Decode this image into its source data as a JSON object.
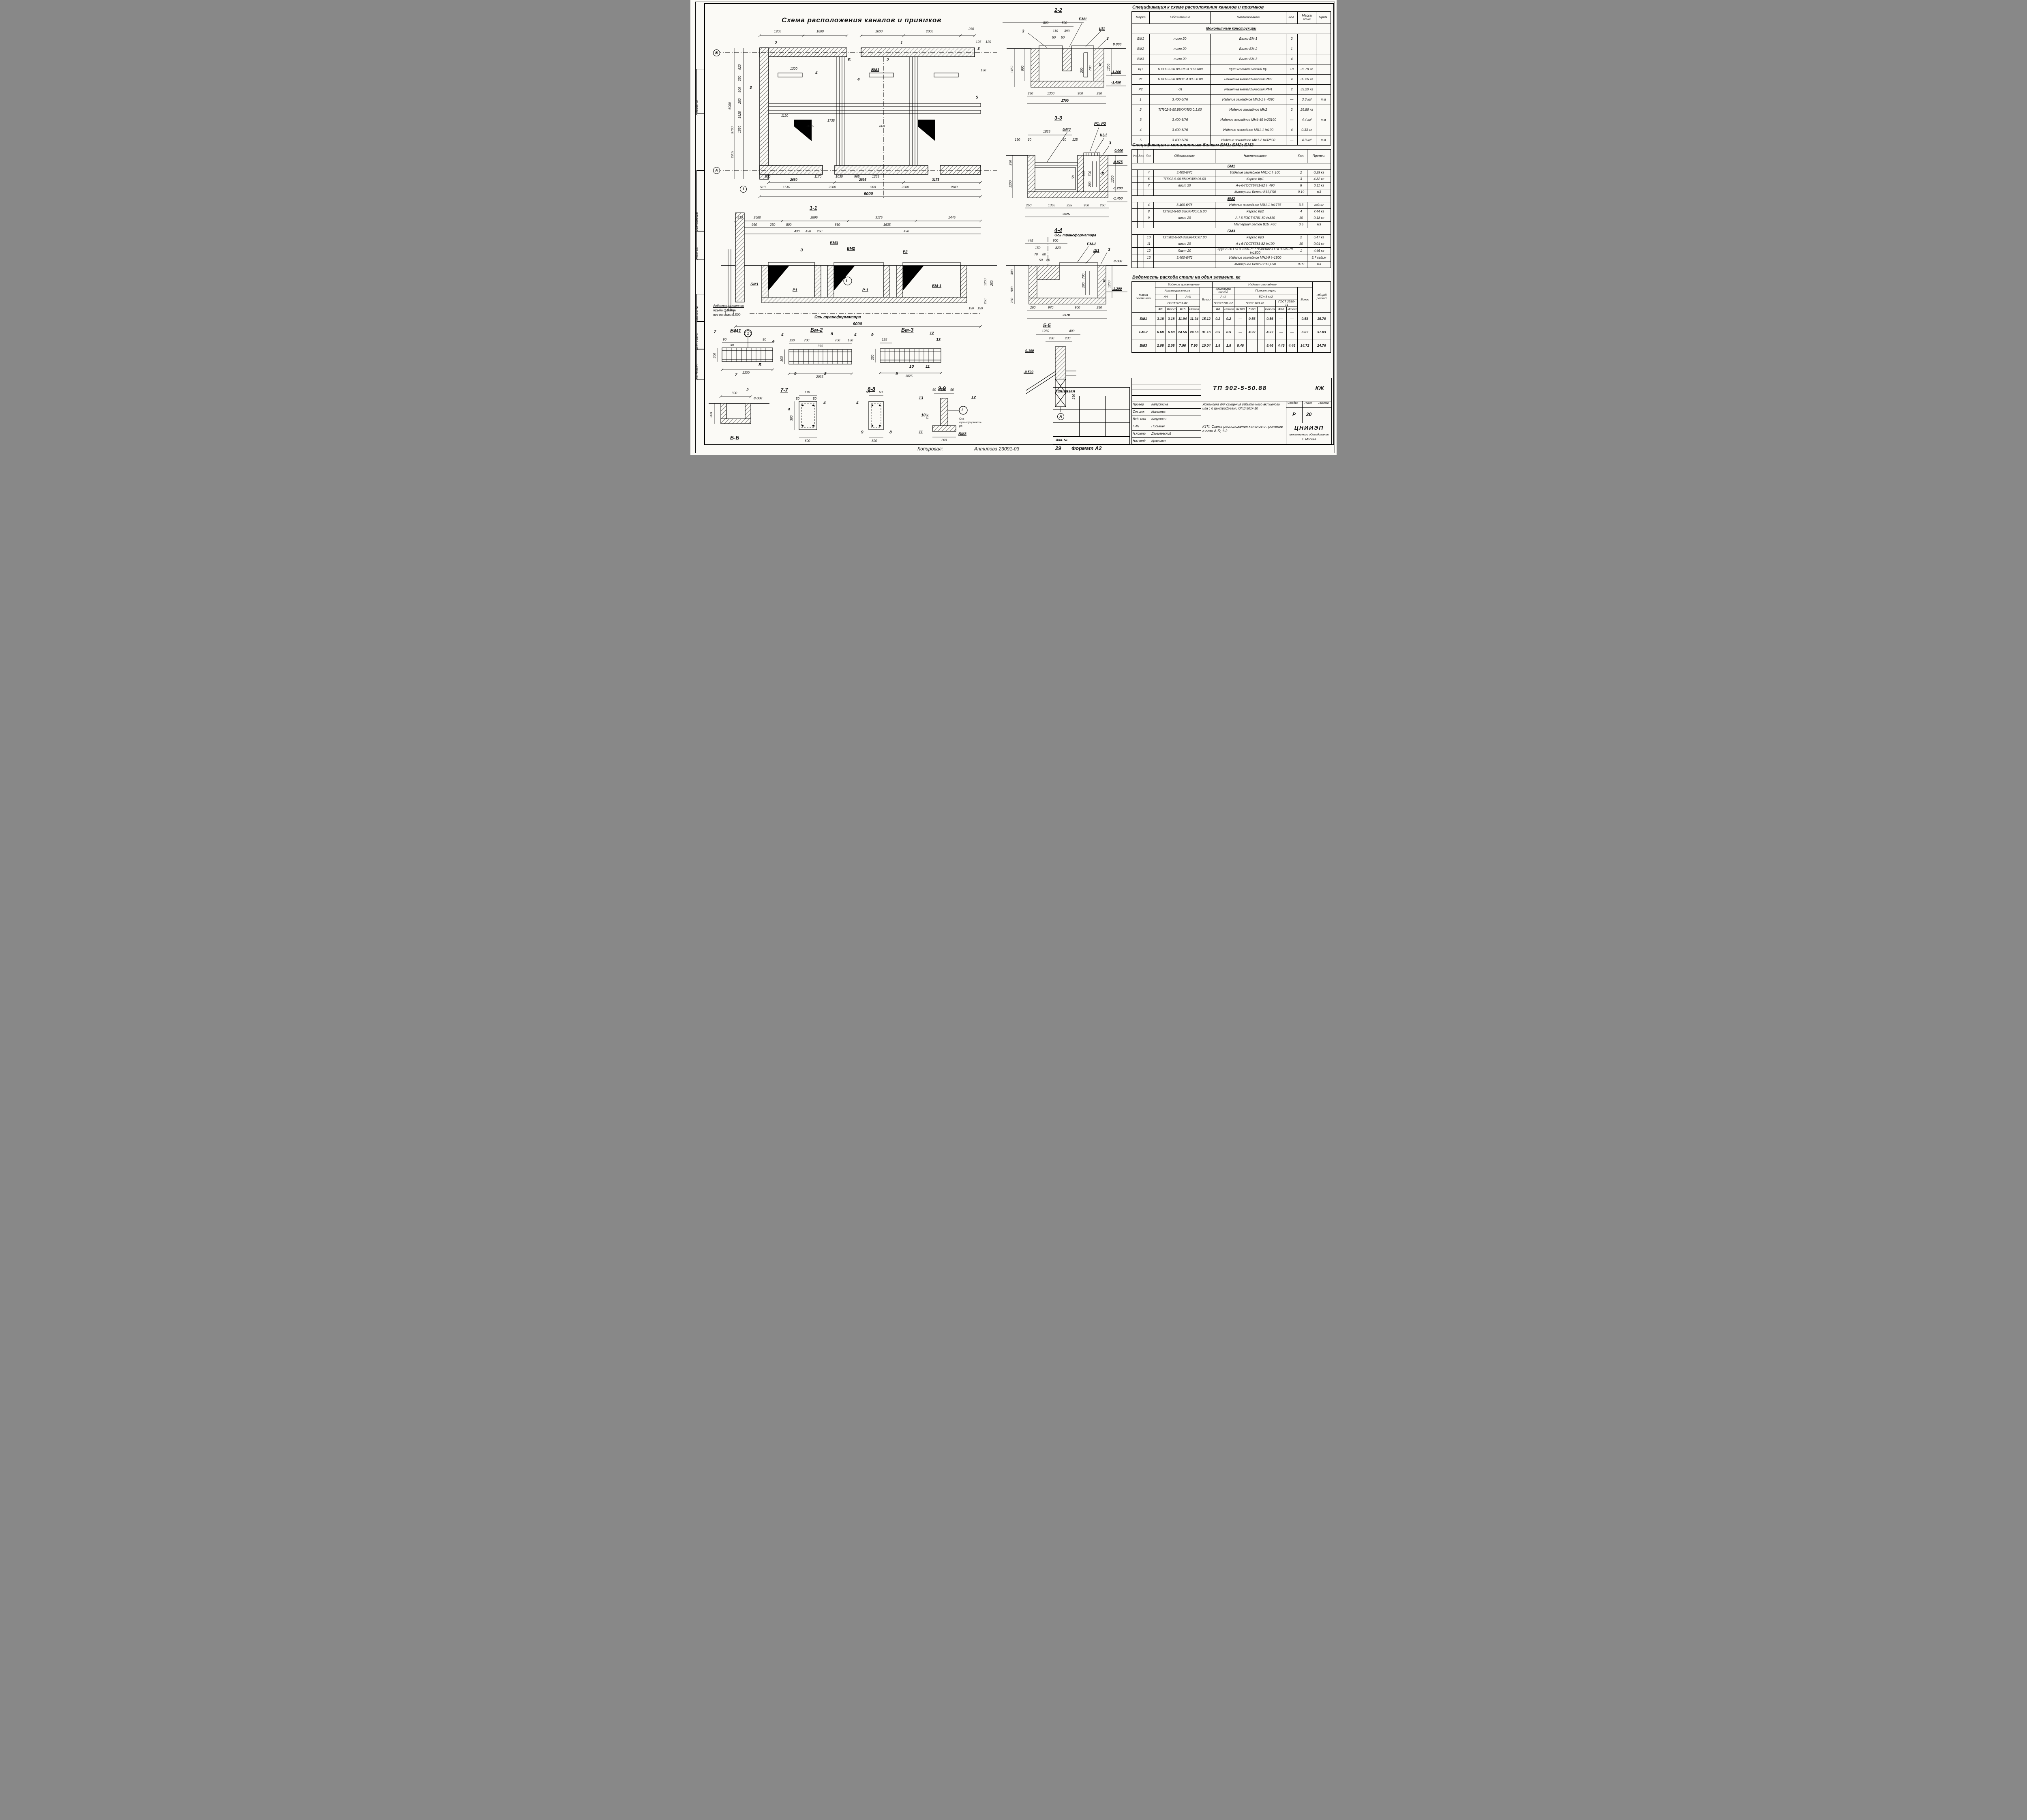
{
  "page": {
    "copied": "Копировал:",
    "copied_by": "Антипова 23091-03",
    "copied_num": "29",
    "format": "Формат А2"
  },
  "sidebar": {
    "album": "Альбом III",
    "agreed": "Согласовано",
    "dept": "Отдел з.д.",
    "vzam": "Взам. инв. №",
    "podp": "Подп. и дата",
    "inv": "Инв. № подл."
  },
  "plan": {
    "title": "Схема расположения каналов и приямков",
    "dims": [
      "1200",
      "1600",
      "1600",
      "2000",
      "250",
      "6000",
      "820",
      "250",
      "900",
      "250",
      "1825",
      "1550",
      "3780",
      "2205",
      "1170",
      "1030",
      "965",
      "1235",
      "500",
      "510",
      "1510",
      "2200",
      "900",
      "2200",
      "1940",
      "9000",
      "2680",
      "2895",
      "3175",
      "150",
      "125",
      "125",
      "2035",
      "860",
      "1300"
    ],
    "marks": [
      "2",
      "Б",
      "1",
      "3",
      "4",
      "БМ1",
      "5",
      "2",
      "3",
      "4",
      "1735",
      "1120"
    ],
    "axis": [
      "Б",
      "А",
      "1"
    ]
  },
  "s11": {
    "title": "1-1",
    "dims": [
      "510",
      "2680",
      "2895",
      "3175",
      "1445",
      "950",
      "250",
      "800",
      "860",
      "1635",
      "430",
      "430",
      "250",
      "490",
      "9000",
      "150",
      "150",
      "1200",
      "250",
      "250"
    ],
    "marks": [
      "3",
      "БМ3",
      "БМ2",
      "Р2",
      "БМ1",
      "Р1",
      "Р-1",
      "БМ-1",
      "З",
      "I"
    ],
    "note": [
      "Асбестоцементная",
      "труба ф100мм",
      "низ на отм.-0.500"
    ],
    "axis_label": "Ось трансформатора"
  },
  "s22": {
    "title": "2-2",
    "dims": [
      "800",
      "500",
      "110",
      "390",
      "50",
      "50",
      "1450",
      "900",
      "200",
      "700",
      "1200",
      "250",
      "1300",
      "900",
      "250",
      "2700"
    ],
    "elev": [
      "0.000",
      "-1.200",
      "-1.450"
    ],
    "marks": [
      "3",
      "БМ1",
      "Щ1",
      "3",
      "5"
    ]
  },
  "s33": {
    "title": "3-3",
    "dims": [
      "1825",
      "190",
      "60",
      "60",
      "125",
      "250",
      "1200",
      "125",
      "700",
      "200",
      "1200",
      "250",
      "1350",
      "225",
      "900",
      "250",
      "3025"
    ],
    "elev": [
      "0.000",
      "-0.875",
      "-1.200",
      "-1.450"
    ],
    "marks": [
      "БМ3",
      "Р1; Р2",
      "Щ-1",
      "3",
      "5",
      "5"
    ]
  },
  "s44": {
    "title": "4-4",
    "axis_label": "Ось трансформатора",
    "dims": [
      "445",
      "900",
      "150",
      "820",
      "70",
      "80",
      "50",
      "60",
      "300",
      "900",
      "250",
      "1200",
      "200",
      "700",
      "260",
      "970",
      "900",
      "250",
      "2370"
    ],
    "elev": [
      "0.000",
      "-1.200"
    ],
    "marks": [
      "БМ-2",
      "Щ1",
      "3",
      "5"
    ]
  },
  "s55": {
    "title": "5-5",
    "dims": [
      "1250",
      "400",
      "280",
      "230",
      "250"
    ],
    "elev": [
      "0.100",
      "-0.500"
    ],
    "axis": "А"
  },
  "bm1": {
    "title": "БМ1",
    "dims": [
      "90",
      "30",
      "90",
      "300",
      "1300"
    ],
    "marks": [
      "7",
      "7",
      "4",
      "Б"
    ],
    "axis": "1"
  },
  "bb": {
    "title": "Б-Б",
    "dims": [
      "300",
      "200"
    ],
    "elev": "0.000",
    "marks": [
      "2"
    ]
  },
  "bm2": {
    "title": "Бм-2",
    "dims": [
      "130",
      "700",
      "375",
      "700",
      "130",
      "300",
      "2035"
    ],
    "marks": [
      "8",
      "8",
      "9",
      "4",
      "4"
    ]
  },
  "s77": {
    "title": "7-7",
    "dims": [
      "110",
      "50",
      "50",
      "300",
      "600"
    ],
    "marks": [
      "4",
      "4"
    ]
  },
  "bm3": {
    "title": "Бм-3",
    "dims": [
      "125",
      "250",
      "1825"
    ],
    "marks": [
      "9",
      "9",
      "12",
      "13",
      "10",
      "11"
    ]
  },
  "s88": {
    "title": "8-8",
    "dims": [
      "50",
      "60",
      "820"
    ],
    "marks": [
      "4",
      "9",
      "8"
    ]
  },
  "s99": {
    "title": "9-9",
    "dims": [
      "50",
      "100",
      "50",
      "200",
      "250"
    ],
    "marks": [
      "13",
      "12",
      "10",
      "11",
      "БМ3",
      "I"
    ],
    "axis_label": [
      "Ось",
      "трансформато-",
      "ра"
    ]
  },
  "spec1": {
    "title": "Спецификация к схеме расположения каналов и приямков",
    "headers": [
      "Марка",
      "Обозначение",
      "Наименование",
      "Кол.",
      "Масса ед.кг",
      "Прим."
    ],
    "rows": [
      "Монолитные конструкции",
      [
        "БМ1",
        "лист 20",
        "Балки  БМ-1",
        "2",
        "",
        ""
      ],
      [
        "БМ2",
        "лист 20",
        "Балки  БМ-2",
        "1",
        "",
        ""
      ],
      [
        "БМ3",
        "лист 20",
        "Балки  БМ-3",
        "4",
        "",
        ""
      ],
      [
        "Щ1",
        "ТП902-5-50.88.КЖ.И.00.6.000",
        "Щит металлический Щ1",
        "18",
        "25.78 кг",
        ""
      ],
      [
        "Р1",
        "ТП902-5-50.88КЖ.И.00.5.0.00",
        "Решетка металлическая РМ3",
        "4",
        "30.26 кг",
        ""
      ],
      [
        "Р2",
        "-01",
        "Решетка металлическая РМ4",
        "2",
        "33.20 кг",
        ""
      ],
      [
        "1",
        "3.400-6/76",
        "Изделие закладное МН1-1 ℓ=4390",
        "—",
        "3.3 кг/",
        "п.м"
      ],
      [
        "2",
        "ТП902-5-50.88КЖИ00.0.1.00",
        "Изделие закладное МН2",
        "2",
        "29.86 кг",
        ""
      ],
      [
        "3",
        "3.400-6/76",
        "Изделие закладное МН4-45 ℓ=23190",
        "—",
        "4.4 кг/",
        "п.м"
      ],
      [
        "4",
        "3.400-6/76",
        "Изделие закладное МИ1-1 ℓ=100",
        "4",
        "0.33 кг",
        ""
      ],
      [
        "5",
        "3.400-6/76",
        "Изделие закладное МИ1-2 ℓ=32800",
        "—",
        "4.3 кг/",
        "п.м"
      ]
    ]
  },
  "spec2": {
    "title": "Спецификация к монолитным балкам БМ1; БМ2; БМ3",
    "headers": [
      "Форм.",
      "Зона",
      "Поз.",
      "Обозначение",
      "Наименование",
      "Кол.",
      "Примеч."
    ],
    "rows": [
      "БМ1",
      [
        "",
        "",
        "4",
        "3.400-6/76",
        "Изделие закладное МИ1-1 ℓ=100",
        "2",
        "0.29 кг"
      ],
      [
        "",
        "",
        "6",
        "ТП902-5-50.88КЖИ00.06.00",
        "Каркас Кр1",
        "3",
        "4.82 кг"
      ],
      [
        "",
        "",
        "7",
        "лист 20",
        "А-I-6-ГОСТ5781-82  ℓ=490",
        "8",
        "0.11 кг"
      ],
      [
        "",
        "",
        "",
        "",
        "Материал  Бетон В15,F50",
        "0.19",
        "м3"
      ],
      "БМ2",
      [
        "",
        "",
        "4",
        "3.400-6/76",
        "Изделие закладное МИ1-1 ℓ=1775",
        "3.3",
        "кг/п.м"
      ],
      [
        "",
        "",
        "8",
        "Т.П902-5-50.88КЖИ00.0.5.00",
        "Каркас Кр2",
        "4",
        "7.44 кг"
      ],
      [
        "",
        "",
        "9",
        "лист 20",
        "А-I-6-ГОСТ 5781-82  ℓ=810",
        "10",
        "0.18 кг"
      ],
      [
        "",
        "",
        "",
        "",
        "Материал Бетон В15, F50",
        "0.5",
        "м3"
      ],
      "БМ3",
      [
        "",
        "",
        "10",
        "Т.П.902-5-50.88КЖИ00.07.00",
        "Каркас Кр3",
        "2",
        "6.47 кг"
      ],
      [
        "",
        "",
        "11",
        "лист 20",
        "А-I-6-ГОСТ5781-82  ℓ=190",
        "10",
        "0.04 кг"
      ],
      [
        "",
        "",
        "12",
        "Лист 20",
        "Круг 8-20 ГОСТ2590-71 / ВСт3кп2-I ГОСТ535-79 ℓ=1800",
        "1",
        "4.46 кг"
      ],
      [
        "",
        "",
        "13",
        "3.400-6/76",
        "Изделие закладное МН1-9 ℓ=1800",
        "",
        "5.7 кг/п.м"
      ],
      [
        "",
        "",
        "",
        "",
        "Материал  Бетон В15,F50",
        "0.09",
        "м3"
      ]
    ]
  },
  "steel": {
    "title": "Ведомость расхода стали на один элемент, кг",
    "h": {
      "marka": "Марка элемента",
      "arm": "Изделия арматурные",
      "zakl": "Изделия закладные",
      "total": "Общий расход",
      "arm_class": "Арматура класса",
      "vsego": "Всего",
      "prokat": "Прокат марки",
      "ai": "А-I",
      "aiii": "А-III",
      "vst": "ВСт3 кп2",
      "gost5781": "ГОСТ 5781-82",
      "gost5781b": "ГОСТ5781-82",
      "gost103": "ГОСТ 103-76",
      "gost2590": "ГОСТ 2590-71",
      "f6": "Ф6",
      "f16": "Ф16",
      "f8": "Ф8",
      "f20": "Ф20",
      "itogo": "Итого",
      "s6100": "6х100",
      "s560": "5х60"
    },
    "rows": [
      [
        "БМ1",
        "3.18",
        "3.18",
        "11.94",
        "11.94",
        "15.12",
        "0.2",
        "0.2",
        "—",
        "0.56",
        "",
        "0.56",
        "—",
        "—",
        "0.58",
        "15.70"
      ],
      [
        "БМ-2",
        "6.60",
        "6.60",
        "24.56",
        "24.56",
        "31.16",
        "0.9",
        "0.9",
        "—",
        "4.97",
        "",
        "4.97",
        "—",
        "—",
        "6.87",
        "37.03"
      ],
      [
        "БМ3",
        "2.08",
        "2.08",
        "7.96",
        "7.96",
        "10.04",
        "1.8",
        "1.8",
        "8.46",
        "",
        "",
        "8.46",
        "4.46",
        "4.46",
        "14.72",
        "24.76"
      ]
    ]
  },
  "tb": {
    "pri": "Привязан",
    "inv": "Инв. №",
    "doc": "ТП  902-5-50.88",
    "code": "КЖ",
    "sig": [
      [
        "Провер",
        "Капустина"
      ],
      [
        "Ст.инж",
        "Киселева"
      ],
      [
        "Вед. инж",
        "Капустин"
      ],
      [
        "ГИП",
        "Письман"
      ],
      [
        "Н.контр.",
        "Данилевский"
      ],
      [
        "Нач отд",
        "Красовин"
      ]
    ],
    "desc": "Установка для сгущения избыточного активного ила с 6 центрифугами ОГШ 501к-10",
    "sheet_title": "КТП. Схема расположения каналов и приямков в осях А-Б; 1-2.",
    "stage_h": [
      "Стадия",
      "Лист",
      "Листов"
    ],
    "stage": [
      "Р",
      "20",
      ""
    ],
    "org1": "ЦНИИЭП",
    "org2": "инженерного оборудования",
    "org3": "г. Москва"
  }
}
